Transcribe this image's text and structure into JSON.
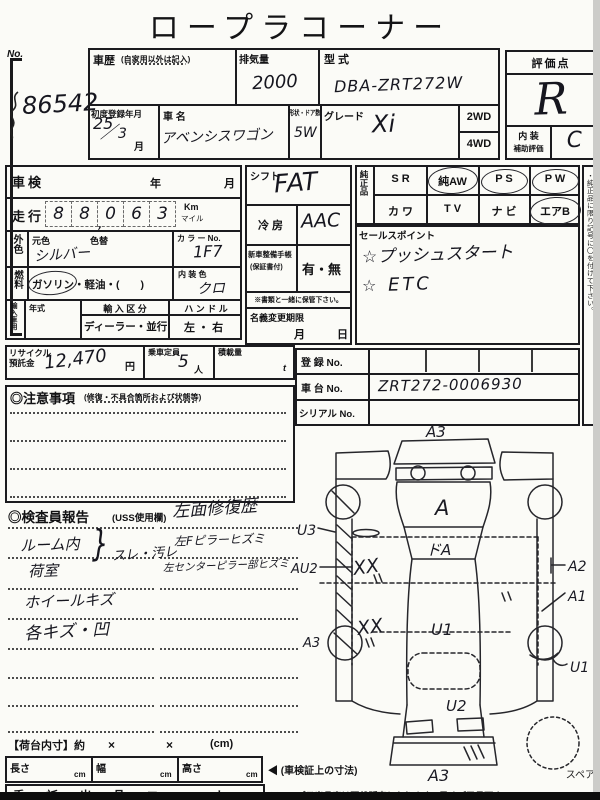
{
  "colors": {
    "ink": "#1a1a1c",
    "paper": "#fbfbf7"
  },
  "page": {
    "title": "ロープラコーナー"
  },
  "auction": {
    "no_label": "No.",
    "number": "86542"
  },
  "header": {
    "history_label": "車歴",
    "history_note": "(自家用以外は記入)",
    "displacement_label": "排気量",
    "displacement_value": "2000",
    "model_label": "型 式",
    "model_value": "DBA-ZRT272W",
    "first_reg_label": "初度登録年月",
    "first_reg_year": "25",
    "first_reg_slash": "／",
    "first_reg_month": "3",
    "month_suffix": "月",
    "car_name_label": "車 名",
    "car_name_value": "アベンシスワゴン",
    "shape_label": "形状・ドア数",
    "shape_value": "5W",
    "grade_label": "グレード",
    "grade_value": "Xi",
    "drive_option1": "2WD",
    "drive_option2": "4WD",
    "score_label": "評価点",
    "score_value": "R",
    "interior_label_line1": "内 装",
    "interior_label_line2": "補助評価",
    "interior_value": "C"
  },
  "left": {
    "shaken_label": "車検",
    "year_mark": "年",
    "month_mark": "月",
    "mileage_label": "走行",
    "digits": [
      "8",
      "8",
      "0",
      "6",
      "3"
    ],
    "comma": ",",
    "unit_km": "Km",
    "unit_mile": "マイル",
    "ext_color_label": "外色",
    "base_color_label": "元色",
    "repaint_label": "色替",
    "base_color_value": "シルバー",
    "color_no_label": "カ ラ ー No.",
    "color_no_value": "1F7",
    "fuel_label": "燃料",
    "fuel_options": "ガソリン・軽油・(　　)",
    "int_color_label": "内 装 色",
    "int_color_value": "クロ",
    "import_label": "輸入車用",
    "year_type_label": "年式",
    "import_class_label": "輸 入 区 分",
    "import_class_options": "ディーラー・並行",
    "handle_label": "ハ ン ド ル",
    "handle_options": "左 ・ 右",
    "recycle_label1": "リサイクル",
    "recycle_label2": "預託金",
    "recycle_value": "12,470",
    "yen": "円",
    "capacity_label": "乗車定員",
    "capacity_value": "5",
    "capacity_unit": "人",
    "load_label": "積載量",
    "load_unit": "t"
  },
  "middle": {
    "shift_label": "シフト",
    "shift_value": "FAT",
    "ac_label": "冷 房",
    "ac_value": "AAC",
    "booklet_label": "新車整備手帳",
    "booklet_note": "(保証書付)",
    "booklet_options": "有・無",
    "keep_note": "※書類と一緒に保管下さい。",
    "transfer_label": "名義変更期限",
    "month_mark": "月",
    "day_mark": "日"
  },
  "equipment": {
    "label": "純正品",
    "cells": [
      "S R",
      "純AW",
      "P S",
      "P W",
      "カ ワ",
      "T V",
      "ナ ビ",
      "エアB"
    ],
    "vertical_note": "・純正品に限り記号に〇を付けて下さい。"
  },
  "sales": {
    "label": "セールスポイント",
    "point1": "☆プッシュスタート",
    "point2_star": "☆",
    "point2_text": "ETC"
  },
  "registration": {
    "reg_label": "登 録 No.",
    "reg_value": "",
    "chassis_label": "車 台 No.",
    "chassis_value": "ZRT272-0006930",
    "serial_label": "シリアル No.",
    "serial_value": ""
  },
  "notes": {
    "title": "◎注意事項",
    "subtitle": "(修復・不具合箇所および状態等)"
  },
  "inspector": {
    "title": "◎検査員報告",
    "subtitle": "(USS使用欄)",
    "headline": "左面修復歴",
    "room": "ルーム内",
    "brace": "}",
    "wear": "スレ・汚レ",
    "cargo_room": "荷室",
    "pillar1": "左Fピラーヒズミ",
    "pillar2": "左センターピラー部ヒズミ",
    "wheel": "ホイールキズ",
    "dents": "各キズ・凹"
  },
  "diagram": {
    "front_bumper": "A3",
    "hood": "A",
    "windshield": "ドA",
    "roof": "U1",
    "rear_window": "U2",
    "rear_bumper": "A3",
    "left_side": "U3",
    "left_door_mark1": "XX",
    "left_door_mark2": "XX",
    "left_center": "AU2",
    "left_rear_wheel": "A3",
    "right_fender": "A2",
    "right_door": "A1",
    "right_rear": "U1",
    "spare": "スペア"
  },
  "cargo": {
    "title": "【荷台内寸】約",
    "x1": "×",
    "x2": "×",
    "unit": "(cm)",
    "length_label": "長さ",
    "width_label": "幅",
    "height_label": "高さ",
    "cm1": "cm",
    "cm2": "cm",
    "cm3": "cm",
    "arrow_note": "◀ (車検証上の寸法)"
  },
  "footer": {
    "cut_left": "委 託 出 品 コ ー ナ ー",
    "cut_right": "※ロープラ出品車は現状販売となります。予めご了承下さい。"
  }
}
